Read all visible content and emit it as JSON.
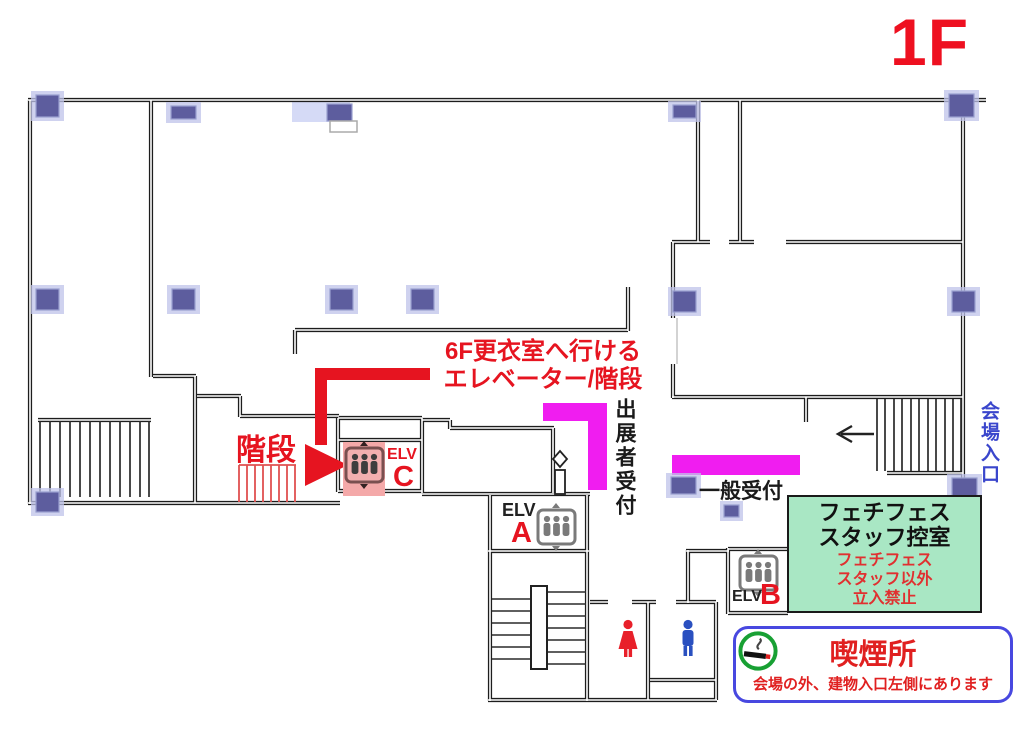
{
  "floor_label": "1F",
  "route_note": {
    "line1": "6F更衣室へ行ける",
    "line2": "エレベーター/階段"
  },
  "labels": {
    "stairs": "階段",
    "exhibitor_reception": "出展者受付",
    "general_reception": "一般受付",
    "venue_entrance": "会場入口"
  },
  "elevators": {
    "a": {
      "label": "ELV",
      "letter": "A"
    },
    "b": {
      "label": "ELV",
      "letter": "B"
    },
    "c": {
      "label": "ELV",
      "letter": "C"
    }
  },
  "staff_room": {
    "title_line1": "フェチフェス",
    "title_line2": "スタッフ控室",
    "notice_line1": "フェチフェス",
    "notice_line2": "スタッフ以外",
    "notice_line3": "立入禁止"
  },
  "smoking_area": {
    "title": "喫煙所",
    "note": "会場の外、建物入口左側にあります"
  },
  "icons": {
    "elevator": "elevator-pictogram",
    "smoking": "cigarette-in-green-circle",
    "female_toilet": "female-pictogram",
    "male_toilet": "male-pictogram",
    "route_arrow": "red-route-arrow",
    "entrance_arrow": "left-arrow"
  },
  "colors": {
    "accent_red": "#e61420",
    "reception_magenta": "#f01df0",
    "staff_room_green": "#a9e7c4",
    "smoking_border_blue": "#4848e0",
    "entrance_text_blue": "#3a46cc",
    "pillar_blue": "#5d5d9e",
    "wall_black": "#1d1d1d"
  }
}
